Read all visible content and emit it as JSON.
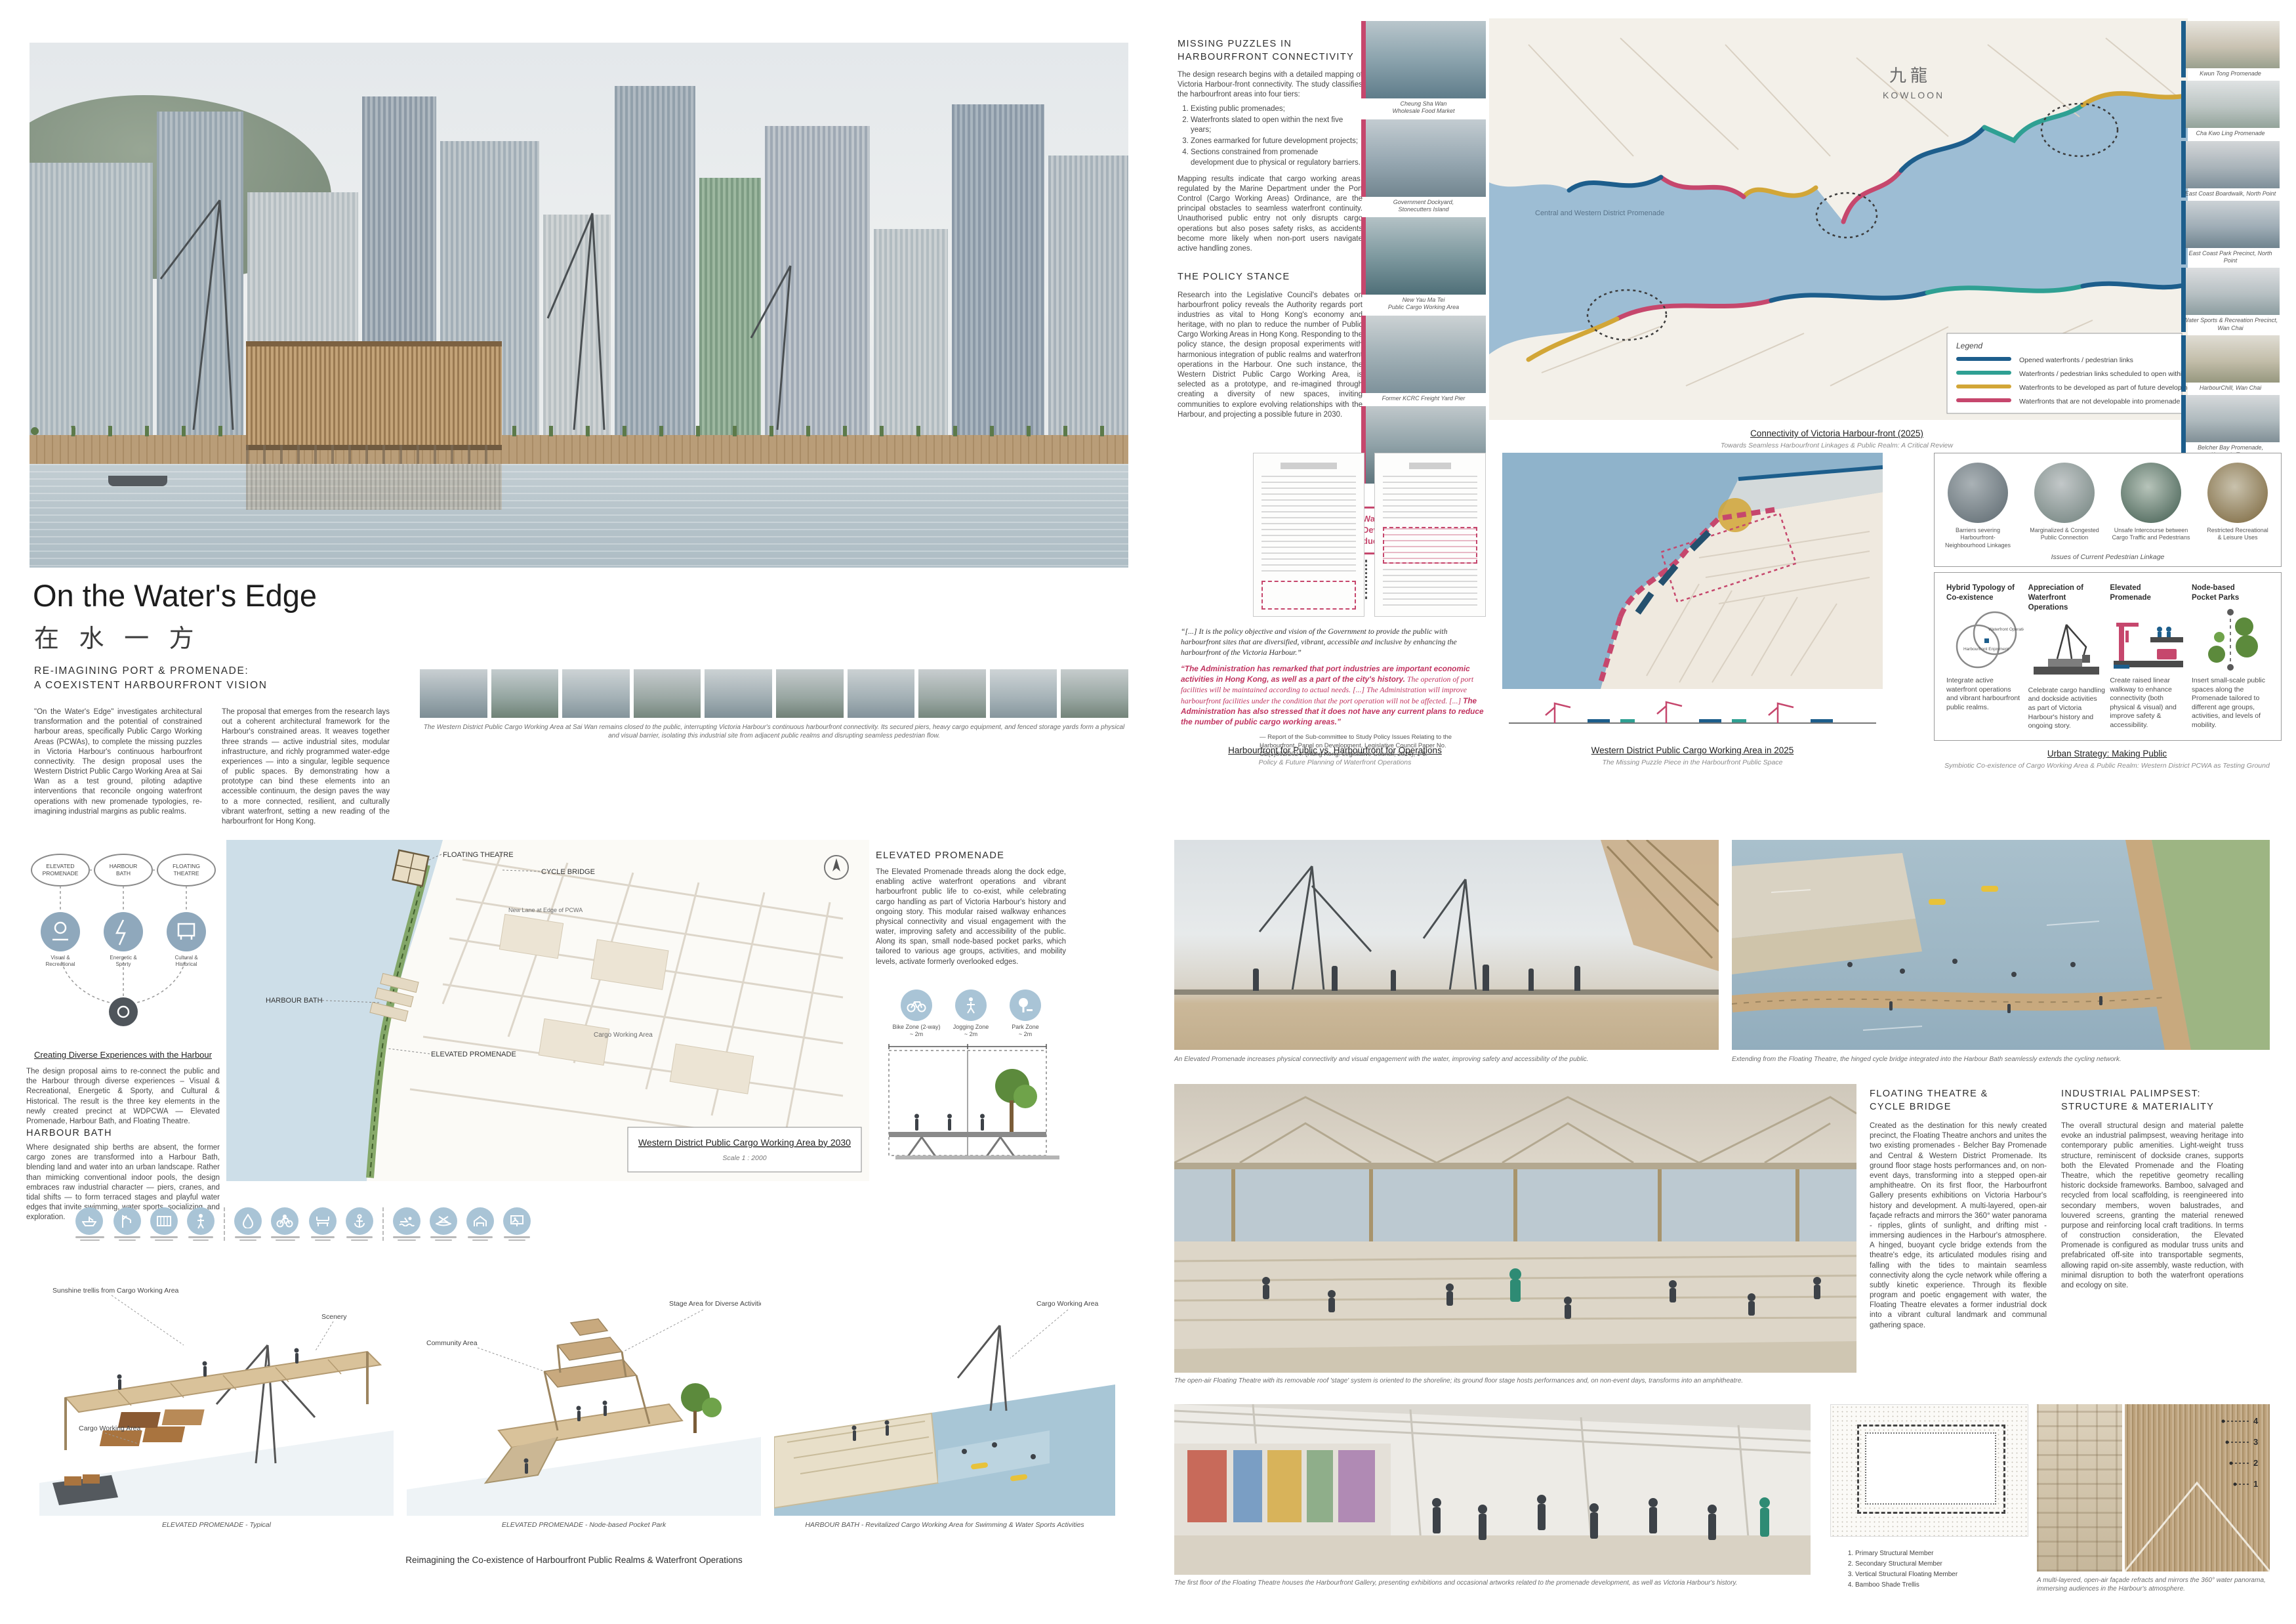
{
  "accents": {
    "pink": "#c6476d",
    "blue": "#1d5e8c",
    "teal": "#2fa093",
    "gold": "#d2a637",
    "icon_blue": "#a9c4d6",
    "quote_red": "#c0335f"
  },
  "hero": {
    "title": "On the Water's Edge",
    "title_zh": "在 水 一 方",
    "tagline": "RE-IMAGINING PORT & PROMENADE:\nA COEXISTENT HARBOURFRONT VISION",
    "para1": "\"On the Water's Edge\" investigates architectural transformation and the potential of constrained harbour areas, specifically Public Cargo Working Areas (PCWAs), to complete the missing puzzles in Victoria Harbour's continuous harbourfront connectivity. The design proposal uses the Western District Public Cargo Working Area at Sai Wan as a test ground, piloting adaptive interventions that reconcile ongoing waterfront operations with new promenade typologies, re-imagining industrial margins as public realms.",
    "para2": "The proposal that emerges from the research lays out a coherent architectural framework for the Harbour's constrained areas. It weaves together three strands — active industrial sites, modular infrastructure, and richly programmed water-edge experiences — into a singular, legible sequence of public spaces. By demonstrating how a prototype can bind these elements into an accessible continuum, the design paves the way to a more connected, resilient, and culturally vibrant waterfront, setting a new reading of the harbourfront for Hong Kong.",
    "strip_caption": "The Western District Public Cargo Working Area at Sai Wan remains closed to the public, interrupting Victoria Harbour's continuous harbourfront connectivity. Its secured piers, heavy cargo equipment, and fenced storage yards form a physical and visual barrier, isolating this industrial site from adjacent public realms and disrupting seamless pedestrian flow."
  },
  "connectivity": {
    "heading": "MISSING PUZZLES IN\nHARBOURFRONT CONNECTIVITY",
    "intro": "The design research begins with a detailed mapping of Victoria Harbour-front connectivity. The study classifies the harbourfront areas into four tiers:",
    "tiers": [
      "Existing public promenades;",
      "Waterfronts slated to open within the next five years;",
      "Zones earmarked for future development projects;",
      "Sections constrained from promenade development due to physical or regulatory barriers."
    ],
    "mapping": "Mapping results indicate that cargo working areas, regulated by the Marine Department under the Port Control (Cargo Working Areas) Ordinance, are the principal obstacles to seamless waterfront continuity. Unauthorised public entry not only disrupts cargo operations but also poses safety risks, as accidents become more likely when non-port users navigate active handling zones."
  },
  "policy": {
    "heading": "THE POLICY STANCE",
    "body": "Research into the Legislative Council's debates on harbourfront policy reveals the Authority regards port industries as vital to Hong Kong's economy and heritage, with no plan to reduce the number of Public Cargo Working Areas in Hong Kong. Responding to the policy stance, the design proposal experiments with harmonious integration of public realms and waterfront operations in the Harbour. One such instance, the Western District Public Cargo Working Area, is selected as a prototype, and re-imagined through creating a diversity of new spaces, inviting communities to explore evolving relationships with the Harbour, and projecting a possible future in 2030."
  },
  "big_map": {
    "caption": "Connectivity of Victoria Harbour-front (2025)",
    "subcaption": "Towards Seamless Harbourfront Linkages & Public Realm: A Critical Review",
    "kowloon_zh": "九龍",
    "kowloon_en": "KOWLOON",
    "annotation": "Central and Western District Promenade",
    "legend_title": "Legend",
    "legend": [
      {
        "color": "#1d5e8c",
        "label": "Opened waterfronts / pedestrian links"
      },
      {
        "color": "#2fa093",
        "label": "Waterfronts / pedestrian links scheduled to open within the next five years"
      },
      {
        "color": "#d2a637",
        "label": "Waterfronts to be developed as part of future development projects"
      },
      {
        "color": "#c6476d",
        "label": "Waterfronts that are not developable into promenade due to existing constraints"
      }
    ]
  },
  "left_strip": {
    "items": [
      "Cheung Sha Wan\nWholesale Food Market",
      "Government Dockyard,\nStonecutters Island",
      "New Yau Ma Tei\nPublic Cargo Working Area",
      "Former KCRC Freight Yard Pier",
      "Western District\nPublic Cargo Working Area"
    ],
    "note": "Waterfronts that are not Developable into Promenade due to Existing Constraints"
  },
  "right_strip": {
    "items": [
      "Kwun Tong Promenade",
      "Cha Kwo Ling Promenade",
      "East Coast Boardwalk, North Point",
      "East Coast Park Precinct, North Point",
      "Water Sports & Recreation Precinct,\nWan Chai",
      "HarbourChill, Wan Chai",
      "Belcher Bay Promenade,\nKennedy Town"
    ],
    "note": "Opened Waterfronts /\nPedestrian Links"
  },
  "docs_quote": {
    "quote1": "“[...] It is the policy objective and vision of the Government to provide the public with harbourfront sites that are diversified, vibrant, accessible and inclusive by enhancing the harbourfront of the Victoria Harbour.”",
    "quote2_bold_a": "“The Administration has remarked that port industries are important economic activities in Hong Kong, as well as a part of the city's history.",
    "quote2_italic": " The operation of port facilities will be maintained according to actual needs. [...] The Administration will improve harbourfront facilities under the condition that the port operation will not be affected. [...] ",
    "quote2_bold_b": "The Administration has also stressed that it does not have any current plans to reduce the number of public cargo working areas.”",
    "attribution": "—  Report of the Sub-committee to Study Policy Issues Relating to the Harbourfront, Panel on Development, Legislative Council Paper No. CB(1)892/2024. (Hong Kong: Legislative Council, 2024), 1-5.",
    "caption": "Harbourfront for Public  vs.  Harbourfront for Operations",
    "subcaption": "Policy & Future Planning of Waterfront Operations"
  },
  "wd_map": {
    "caption": "Western District Public Cargo Working Area in 2025",
    "subcaption": "The Missing Puzzle Piece in the Harbourfront Public Space"
  },
  "issues_panel": {
    "items": [
      "Barriers severing Harbourfront-\nNeighbourhood Linkages",
      "Marginalized & Congested\nPublic Connection",
      "Unsafe Intercourse between\nCargo Traffic and Pedestrians",
      "Restricted Recreational\n& Leisure Uses"
    ],
    "caption": "Issues of Current Pedestrian Linkage"
  },
  "strategy_panel": {
    "caption": "Urban Strategy: Making Public",
    "subcaption": "Symbiotic Co-existence of Cargo Working Area & Public Realm: Western District PCWA as Testing Ground",
    "items": [
      {
        "title": "Hybrid Typology of\nCo-existence",
        "desc": "Integrate active waterfront operations and vibrant harbourfront public realms.",
        "venn_a": "Waterfront\nOperations",
        "venn_b": "Harbourfront\nEnjoyment"
      },
      {
        "title": "Appreciation of\nWaterfront Operations",
        "desc": "Celebrate cargo handling and dockside activities as part of Victoria Harbour's history and ongoing story."
      },
      {
        "title": "Elevated\nPromenade",
        "desc": "Create raised linear walkway to enhance connectivity (both physical & visual) and improve safety & accessibility."
      },
      {
        "title": "Node-based\nPocket Parks",
        "desc": "Insert small-scale public spaces along the Promenade tailored to different age groups, activities, and levels of mobility."
      }
    ]
  },
  "experiences": {
    "heading": "Creating Diverse Experiences with the Harbour",
    "body": "The design proposal aims to re-connect the public and the Harbour through diverse experiences – Visual & Recreational, Energetic & Sporty, and Cultural & Historical. The result is the three key elements in the newly created precinct at WDPCWA — Elevated Promenade, Harbour Bath, and Floating Theatre.",
    "bubbles": [
      "ELEVATED PROMENADE",
      "HARBOUR BATH",
      "FLOATING THEATRE"
    ],
    "categories": [
      "Visual & Recreational",
      "Energetic & Sporty",
      "Cultural & Historical"
    ]
  },
  "harbour_bath": {
    "heading": "HARBOUR BATH",
    "body": "Where designated ship berths are absent, the former cargo zones are transformed into a Harbour Bath, blending land and water into an urban landscape. Rather than mimicking conventional indoor pools, the design embraces raw industrial character — piers, cranes, and tidal shifts — to form terraced stages and playful water edges that invite swimming, water sports, socializing, and exploration."
  },
  "elevated_promenade": {
    "heading": "ELEVATED PROMENADE",
    "body": "The Elevated Promenade threads along the dock edge, enabling active waterfront operations and vibrant harbourfront public life to co-exist, while celebrating cargo handling as part of Victoria Harbour's history and ongoing story. This modular raised walkway enhances physical connectivity and visual engagement with the water, improving safety and accessibility of the public. Along its span, small node-based pocket parks, which tailored to various age groups, activities, and mobility levels, activate formerly overlooked edges.",
    "zones": [
      {
        "label": "Bike Zone (2-way)",
        "dim": "~ 2m"
      },
      {
        "label": "Jogging Zone",
        "dim": "~ 2m"
      },
      {
        "label": "Park Zone",
        "dim": "~ 2m"
      }
    ]
  },
  "siteplan": {
    "labels": {
      "floating_theatre": "FLOATING THEATRE",
      "cycle_bridge": "CYCLE BRIDGE",
      "harbour_bath": "HARBOUR BATH",
      "elevated_promenade": "ELEVATED PROMENADE",
      "cargo": "Cargo Working Area",
      "new_lane": "New Lane at Edge of PCWA"
    },
    "caption": "Western District Public Cargo Working Area by 2030",
    "scale": "Scale 1 : 2000"
  },
  "axons": {
    "captions": [
      "ELEVATED PROMENADE  -  Typical",
      "ELEVATED PROMENADE  -  Node-based Pocket Park",
      "HARBOUR BATH  -  Revitalized Cargo Working Area for Swimming & Water Sports Activities"
    ],
    "labels": {
      "trellis": "Sunshine trellis from Cargo Working Area",
      "scenery": "Scenery",
      "cargo1": "Cargo Working Area",
      "community": "Community Area",
      "stage": "Stage Area for Diverse Activities",
      "cargo2": "Cargo Working Area"
    },
    "bottom_caption": "Reimagining the Co-existence of Harbourfront Public Realms & Waterfront Operations"
  },
  "renders": {
    "promenade_caption": "An Elevated Promenade increases physical connectivity and visual engagement with the water, improving safety and accessibility of the public.",
    "bridge_caption": "Extending from the Floating Theatre, the hinged cycle bridge integrated into the Harbour Bath seamlessly extends the cycling network.",
    "panorama_caption": "The open-air Floating Theatre with its removable roof 'stage' system is oriented to the shoreline; its ground floor stage hosts performances and, on non-event days, transforms into an amphitheatre.",
    "gallery_caption": "The first floor of the Floating Theatre houses the Harbourfront Gallery, presenting exhibitions and occasional artworks related to the promenade development, as well as Victoria Harbour's history.",
    "facade_caption": "A multi-layered, open-air façade refracts and mirrors the 360° water panorama, immersing audiences in the Harbour's atmosphere."
  },
  "floating_theatre": {
    "heading": "FLOATING THEATRE &\nCYCLE BRIDGE",
    "body": "Created as the destination for this newly created precinct, the Floating Theatre anchors and unites the two existing promenades - Belcher Bay Promenade and Central & Western District Promenade. Its ground floor stage hosts performances and, on non-event days, transforming into a stepped open-air amphitheatre. On its first floor, the Harbourfront Gallery presents exhibitions on Victoria Harbour's history and development. A multi-layered, open-air façade refracts and mirrors the 360° water panorama - ripples, glints of sunlight, and drifting mist - immersing audiences in the Harbour's atmosphere. A hinged, buoyant cycle bridge extends from the theatre's edge, its articulated modules rising and falling with the tides to maintain seamless connectivity along the cycle network while offering a subtly kinetic experience. Through its flexible program and poetic engagement with water, the Floating Theatre elevates a former industrial dock into a vibrant cultural landmark and communal gathering space."
  },
  "palimpsest": {
    "heading": "INDUSTRIAL PALIMPSEST:\nSTRUCTURE & MATERIALITY",
    "body": "The overall structural design and material palette evoke an industrial palimpsest, weaving heritage into contemporary public amenities. Light-weight truss structure, reminiscent of dockside cranes, supports both the Elevated Promenade and the Floating Theatre, which the repetitive geometry recalling historic dockside frameworks. Bamboo, salvaged and recycled from local scaffolding, is reengineered into secondary members, woven balustrades, and louvered screens, granting the material renewed purpose and reinforcing local craft traditions. In terms of construction consideration, the Elevated Promenade is configured as modular truss units and prefabricated off-site into transportable segments, allowing rapid on-site assembly, waste reduction, with minimal disruption to both the waterfront operations and ecology on site.",
    "legend": [
      "Primary Structural Member",
      "Secondary Structural Member",
      "Vertical Structural Floating Member",
      "Bamboo Shade Trellis"
    ]
  }
}
